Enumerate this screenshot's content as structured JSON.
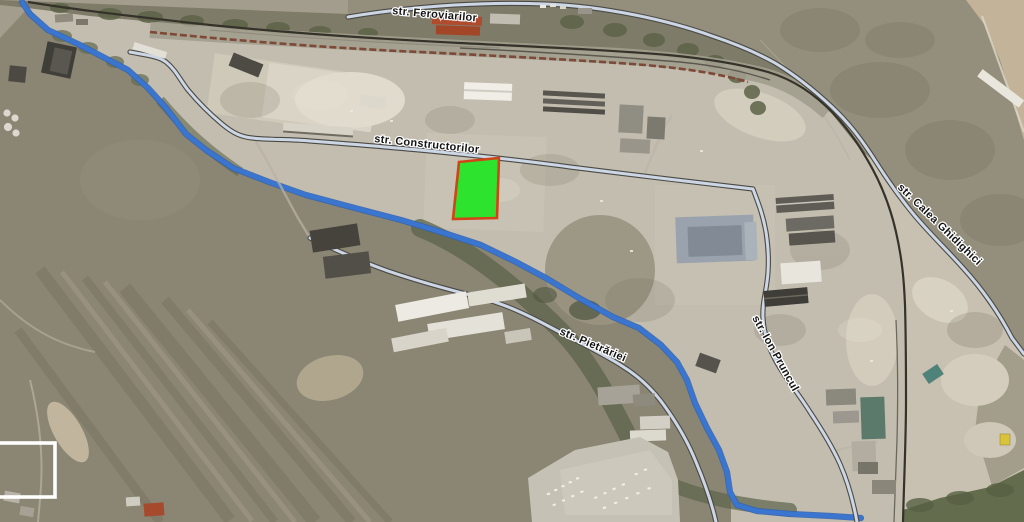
{
  "map": {
    "type": "satellite-aerial-view",
    "streets": {
      "feroviarilor": {
        "label": "str. Feroviarilor"
      },
      "constructorilor": {
        "label": "str. Constructorilor"
      },
      "pietrariei": {
        "label": "str. Pietrăriei"
      },
      "ion_pruncul": {
        "label": "str. Ion Pruncul"
      },
      "calea_ghidighici": {
        "label": "str. Calea Ghidighici"
      }
    },
    "highlighted_plot": {
      "fill": "#2ee32e",
      "border": "#d04418"
    },
    "water_color": "#3a76cf",
    "road_highlight_fill": "#ccd6e4",
    "road_casing": "#4b4a44",
    "selection_box_color": "#ffffff"
  }
}
